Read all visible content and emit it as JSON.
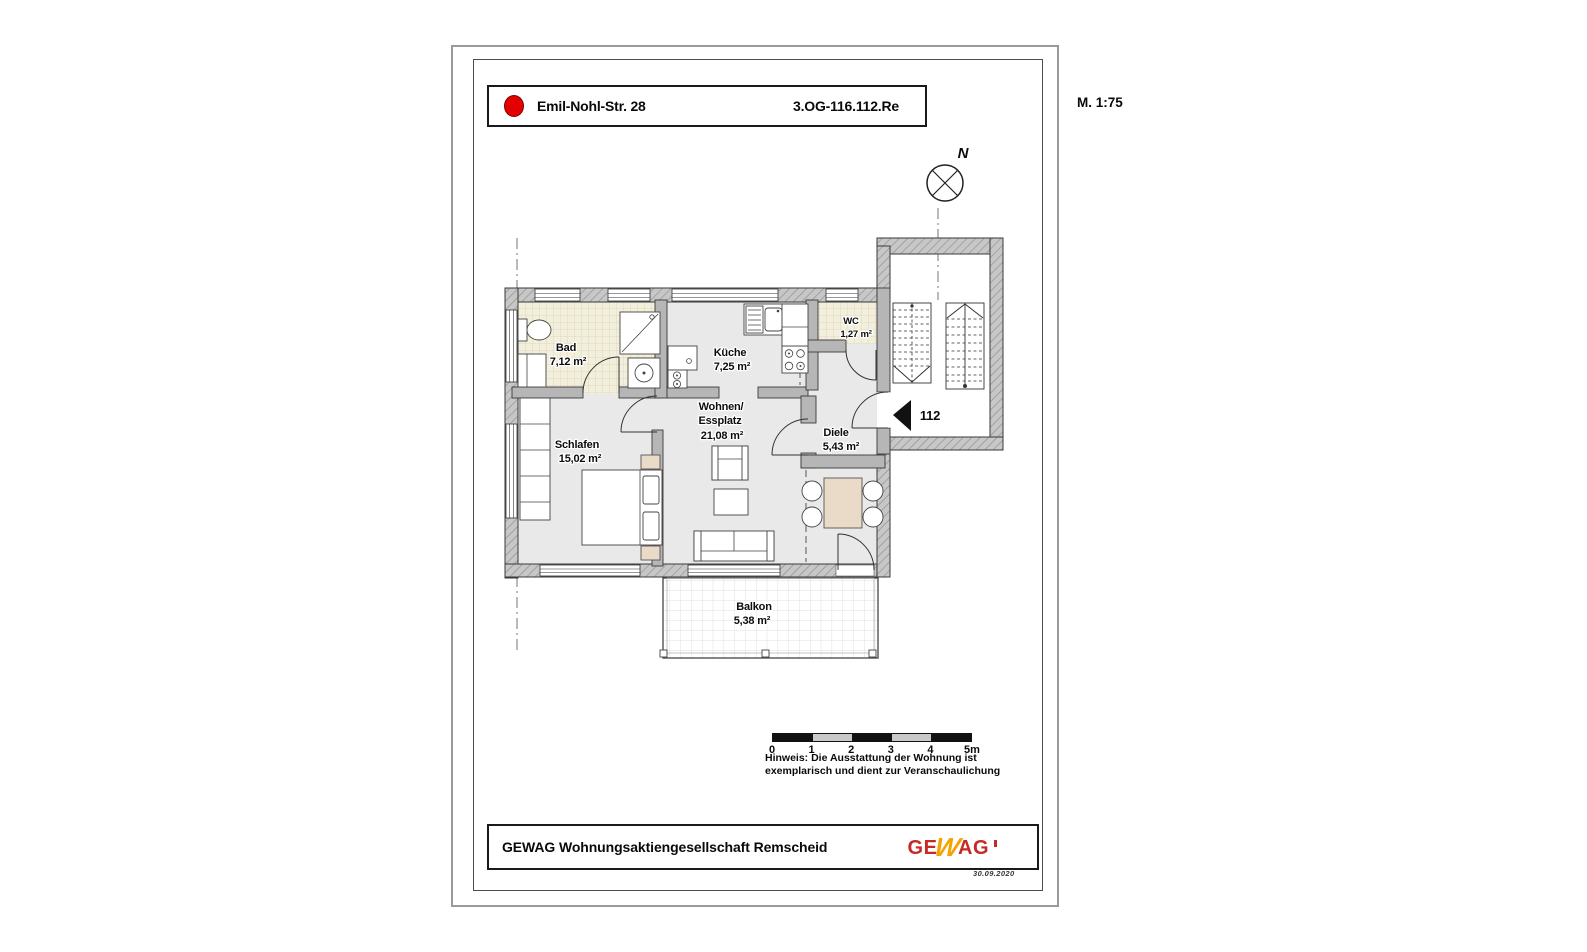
{
  "document": {
    "scale_note": "M. 1:75",
    "date_note": "30.09.2020"
  },
  "title_block": {
    "street": "Emil-Nohl-Str. 28",
    "unit_code": "3.OG-116.112.Re"
  },
  "compass": {
    "north_label": "N"
  },
  "plan": {
    "apartment_number": "112",
    "rooms": {
      "bad": {
        "name": "Bad",
        "area": "7,12 m²"
      },
      "kueche": {
        "name": "Küche",
        "area": "7,25 m²"
      },
      "wc": {
        "name": "WC",
        "area": "1,27 m²"
      },
      "wohnen": {
        "name_line1": "Wohnen/",
        "name_line2": "Essplatz",
        "area": "21,08 m²"
      },
      "schlafen": {
        "name": "Schlafen",
        "area": "15,02 m²"
      },
      "diele": {
        "name": "Diele",
        "area": "5,43 m²"
      },
      "balkon": {
        "name": "Balkon",
        "area": "5,38 m²"
      }
    }
  },
  "scale_bar": {
    "labels": [
      "0",
      "1",
      "2",
      "3",
      "4",
      "5m"
    ]
  },
  "note": {
    "line1": "Hinweis: Die Ausstattung der Wohnung ist",
    "line2": "exemplarisch und dient zur Veranschaulichung"
  },
  "footer": {
    "company": "GEWAG Wohnungsaktiengesellschaft Remscheid",
    "logo": {
      "ge": "GE",
      "w": "W",
      "ag": "AG"
    }
  },
  "colors": {
    "accent_red": "#e40000",
    "logo_red": "#c52b26",
    "logo_yellow": "#f4a300",
    "wall_gray": "#b6b6b6",
    "floor_gray": "#e9e9e9",
    "tile_beige": "#f3efdd"
  }
}
